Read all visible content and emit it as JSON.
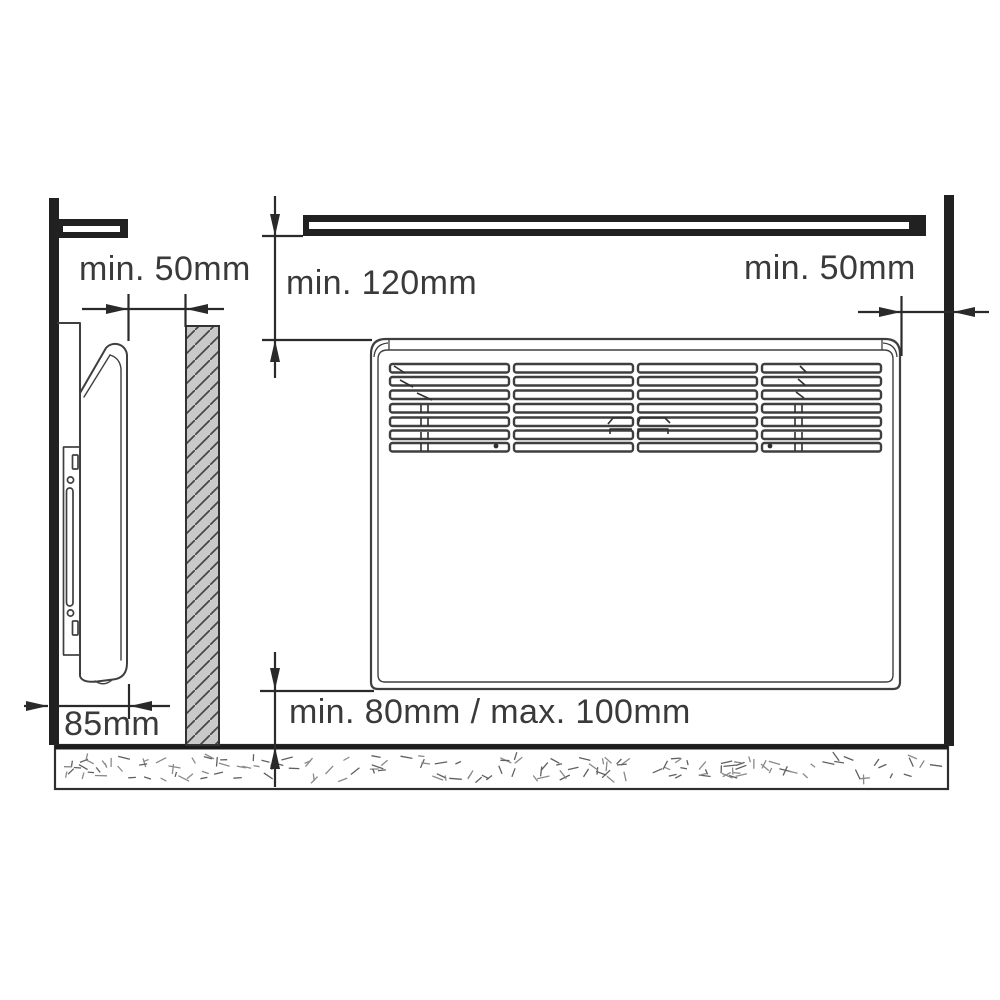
{
  "diagram": {
    "subject": "convector-heater-installation-clearances",
    "dimensions": {
      "top_left": "min. 50mm",
      "top_center": "min. 120mm",
      "top_right": "min. 50mm",
      "bottom_left": "85mm",
      "bottom_center": "min. 80mm / max. 100mm"
    },
    "colors": {
      "heavy_structure": "#212121",
      "drawing_line": "#3f3f3f",
      "dimension_line": "#2a2a2a",
      "label_text": "#3a3a3a",
      "obstacle_fill": "#c9c9c9"
    }
  }
}
